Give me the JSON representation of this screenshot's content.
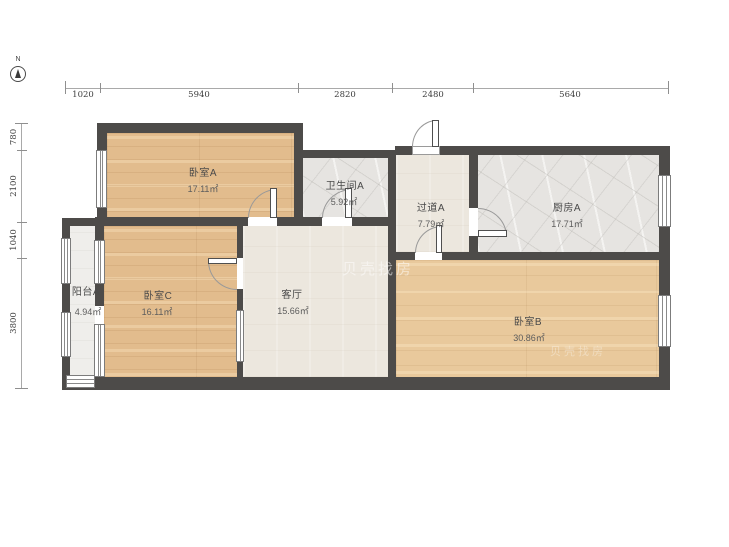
{
  "compass": {
    "label": "N"
  },
  "watermark": "贝壳找房",
  "dimensions": {
    "top": [
      "1020",
      "5940",
      "2820",
      "2480",
      "5640"
    ],
    "left": [
      "780",
      "2100",
      "1040",
      "3800"
    ]
  },
  "rooms": {
    "bedroomA": {
      "name": "卧室A",
      "area": "17.11㎡"
    },
    "bathroomA": {
      "name": "卫生间A",
      "area": "5.92㎡"
    },
    "hallwayA": {
      "name": "过道A",
      "area": "7.79㎡"
    },
    "kitchenA": {
      "name": "厨房A",
      "area": "17.71㎡"
    },
    "balconyA": {
      "name": "阳台A",
      "area": "4.94㎡"
    },
    "bedroomC": {
      "name": "卧室C",
      "area": "16.11㎡"
    },
    "living": {
      "name": "客厅",
      "area": "15.66㎡"
    },
    "bedroomB": {
      "name": "卧室B",
      "area": "30.86㎡"
    }
  },
  "colors": {
    "wall": "#4d4b49",
    "wood": "#e2bc8d",
    "wood_light": "#e9c99c",
    "tile_cream": "#ece7de",
    "tile_marble": "#e6e4e1",
    "balcony": "#efeeeb"
  }
}
